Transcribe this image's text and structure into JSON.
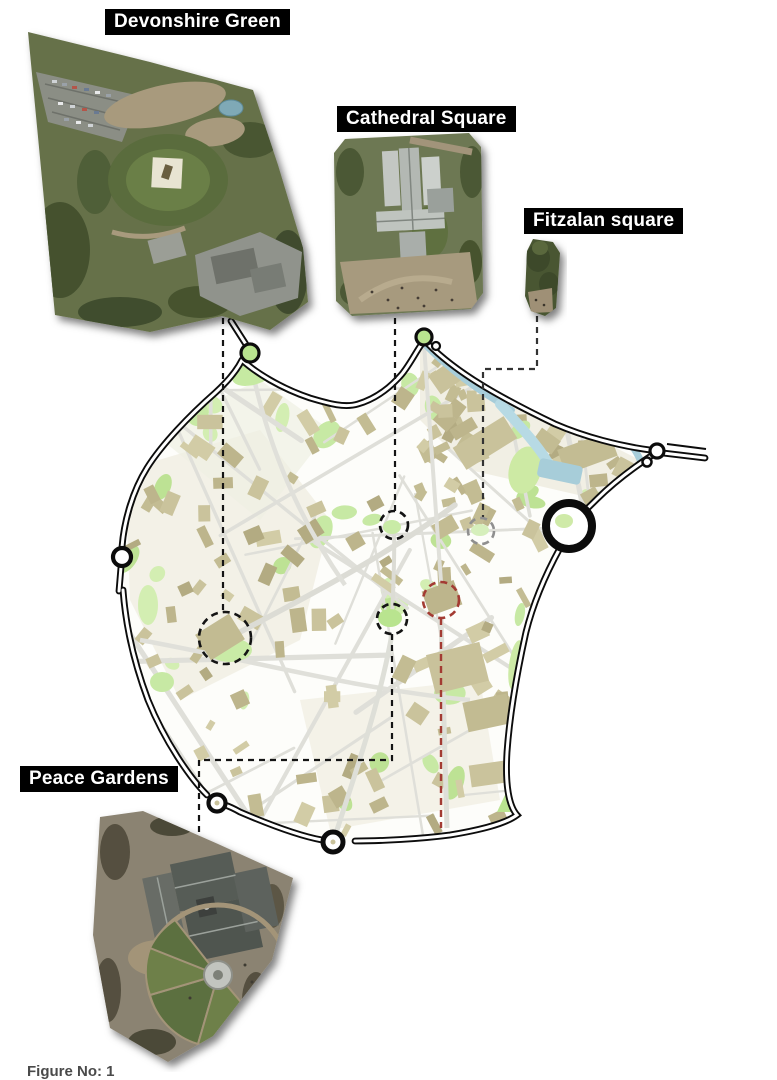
{
  "figure": {
    "kind": "city-centre map with aerial photo callouts",
    "labels": {
      "devonshire": "Devonshire Green",
      "cathedral": "Cathedral Square",
      "fitzalan": "Fitzalan square",
      "peace": "Peace Gardens"
    },
    "caption_partial": "Figure No: 1",
    "locations": [
      {
        "name": "Devonshire Green",
        "marker": "black-dashed-circle"
      },
      {
        "name": "Cathedral Square",
        "marker": "black-dashed-circle"
      },
      {
        "name": "Fitzalan square",
        "marker": "gray-dashed-circle"
      },
      {
        "name": "Peace Gardens",
        "marker": "black-dashed-circle"
      },
      {
        "name": "",
        "marker": "red-dashed-circle"
      }
    ],
    "colors": {
      "label_bg": "#000000",
      "label_text": "#ffffff",
      "map_building": "#c9c29b",
      "map_green": "#cdeaa6",
      "map_street": "#dfdfd9",
      "river": "#a7cdd9",
      "ring_road": "#0c0c0c",
      "marker_black": "#141414",
      "marker_gray": "#8f8f8f",
      "marker_red": "#a33b33"
    }
  }
}
